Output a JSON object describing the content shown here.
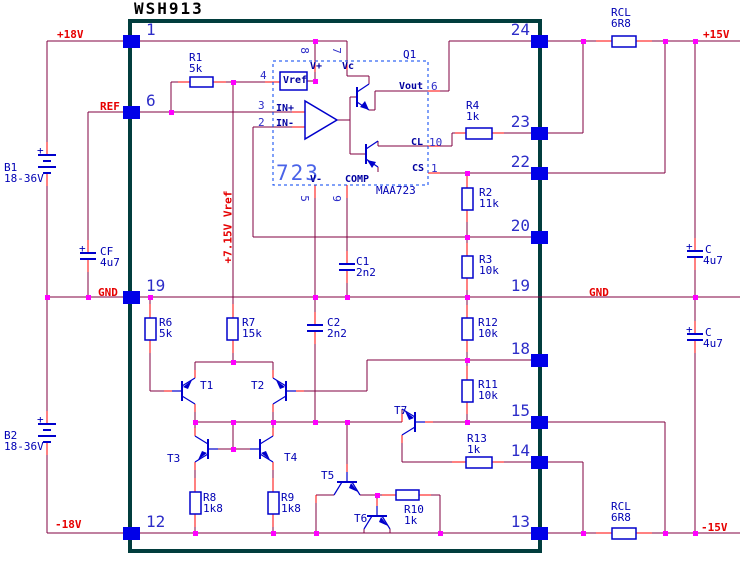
{
  "title": "WSH913",
  "rails": {
    "p18": "+18V",
    "ref": "REF",
    "gnd_l": "GND",
    "n18": "-18V",
    "p15": "+15V",
    "gnd_r": "GND",
    "n15": "-15V",
    "vref_rail": "+7.15V Vref"
  },
  "pins_left": [
    "1",
    "6",
    "19",
    "12"
  ],
  "pins_right": [
    "24",
    "23",
    "22",
    "20",
    "19",
    "18",
    "15",
    "14",
    "13"
  ],
  "ic": {
    "big": "723",
    "part": "MAA723",
    "q": "Q1",
    "vref_block": "Vref",
    "p": {
      "v_plus": "V+",
      "vc": "Vc",
      "vout": "Vout",
      "cl": "CL",
      "cs": "CS",
      "comp": "COMP",
      "v_minus": "V-",
      "in_p": "IN+",
      "in_m": "IN-"
    },
    "n": {
      "n8": "8",
      "n7": "7",
      "n4": "4",
      "n3": "3",
      "n2": "2",
      "n6": "6",
      "n10": "10",
      "n1": "1",
      "n5": "5",
      "n9": "9"
    }
  },
  "r": {
    "r1": [
      "R1",
      "5k"
    ],
    "r4": [
      "R4",
      "1k"
    ],
    "rcl_top": [
      "RCL",
      "6R8"
    ],
    "r2": [
      "R2",
      "11k"
    ],
    "r3": [
      "R3",
      "10k"
    ],
    "r12": [
      "R12",
      "10k"
    ],
    "r11": [
      "R11",
      "10k"
    ],
    "r6": [
      "R6",
      "5k"
    ],
    "r7": [
      "R7",
      "15k"
    ],
    "r8": [
      "R8",
      "1k8"
    ],
    "r9": [
      "R9",
      "1k8"
    ],
    "r10": [
      "R10",
      "1k"
    ],
    "r13": [
      "R13",
      "1k"
    ],
    "rcl_bot": [
      "RCL",
      "6R8"
    ]
  },
  "c": {
    "cf": [
      "CF",
      "4u7"
    ],
    "cu": [
      "C",
      "4u7"
    ],
    "cl2": [
      "C",
      "4u7"
    ],
    "c1": [
      "C1",
      "2n2"
    ],
    "c2": [
      "C2",
      "2n2"
    ],
    "plus": "+"
  },
  "b": {
    "b1": [
      "B1",
      "18-36V"
    ],
    "b2": [
      "B2",
      "18-36V"
    ]
  },
  "t": {
    "t1": "T1",
    "t2": "T2",
    "t3": "T3",
    "t4": "T4",
    "t5": "T5",
    "t6": "T6",
    "t7": "T7"
  },
  "colors": {
    "wire": "#800040",
    "stub": "#ff0000",
    "junction": "#ff00ff",
    "component": "#0000cc",
    "pin_square": "#0000e8",
    "module_border": "#013d3d",
    "label_red": "#e60000",
    "label_blue": "#0000b4"
  }
}
